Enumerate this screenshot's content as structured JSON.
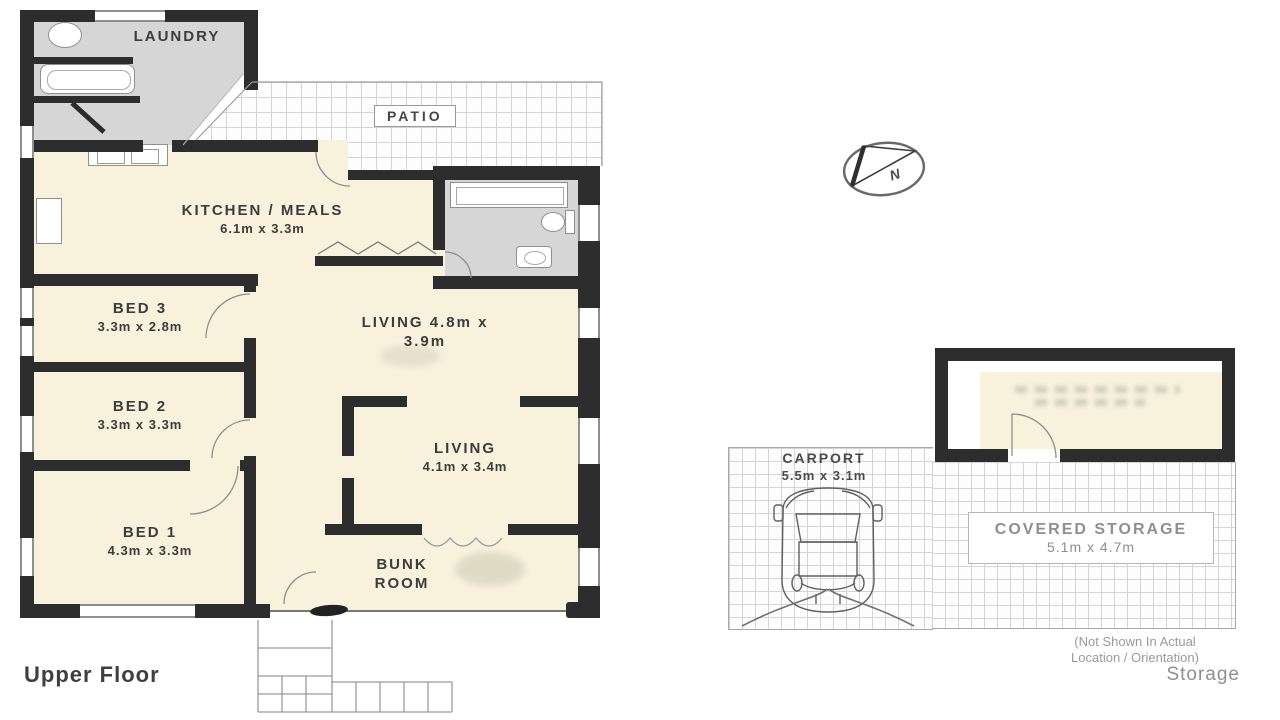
{
  "colors": {
    "wall": "#2d2d2d",
    "room_fill": "#f8f1dc",
    "wet_area_floor": "#d6d6d6",
    "grid_line": "#d4d4d4",
    "label_text": "#3c3c3c",
    "muted_text": "#8f8f8f"
  },
  "plan": {
    "floor_label": "Upper Floor",
    "rooms": {
      "laundry": {
        "name": "LAUNDRY"
      },
      "patio": {
        "name": "PATIO"
      },
      "kitchen": {
        "name": "KITCHEN / MEALS",
        "dims": "6.1m x 3.3m"
      },
      "living_upper": {
        "line1": "LIVING 4.8m x",
        "line2": "3.9m"
      },
      "living_lower": {
        "name": "LIVING",
        "dims": "4.1m x 3.4m"
      },
      "bed1": {
        "name": "BED 1",
        "dims": "4.3m x 3.3m"
      },
      "bed2": {
        "name": "BED 2",
        "dims": "3.3m x 3.3m"
      },
      "bed3": {
        "name": "BED 3",
        "dims": "3.3m x 2.8m"
      },
      "bunk": {
        "line1": "BUNK",
        "line2": "ROOM"
      }
    }
  },
  "outbuilding": {
    "carport": {
      "name": "CARPORT",
      "dims": "5.5m x 3.1m"
    },
    "covered_storage": {
      "name": "COVERED STORAGE",
      "dims": "5.1m x 4.7m"
    },
    "note_line1": "(Not Shown In Actual",
    "note_line2": "Location / Orientation)",
    "label": "Storage"
  },
  "compass": {
    "label": "N"
  }
}
